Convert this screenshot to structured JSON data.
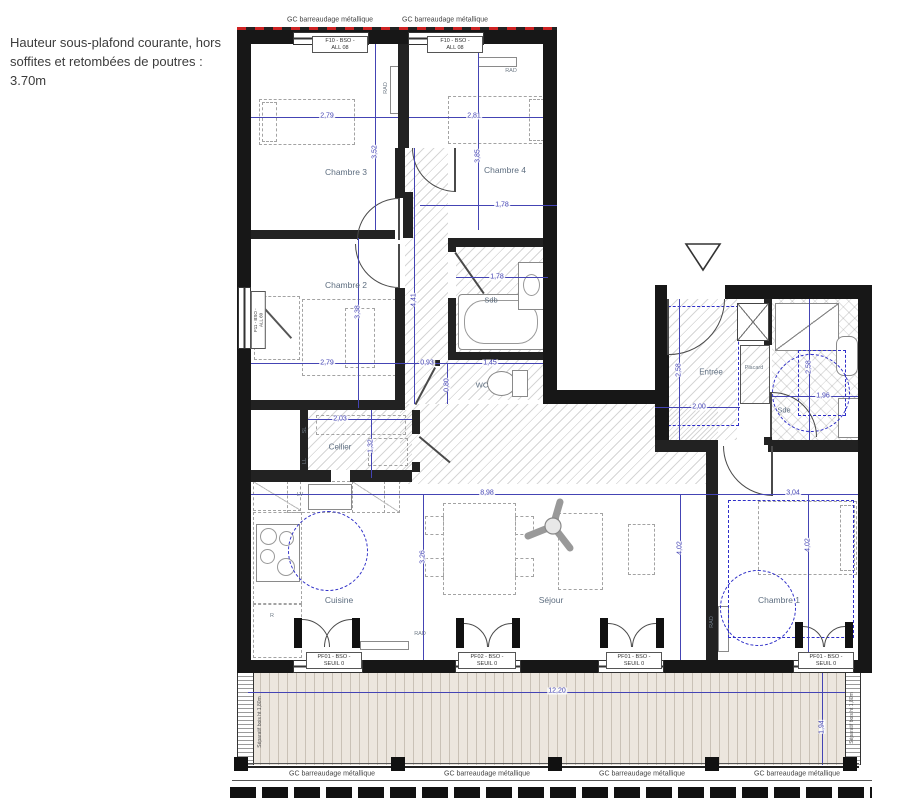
{
  "note": "Hauteur sous-plafond courante, hors\nsoffites et retombées de poutres :\n3.70m",
  "labels": {
    "gc_railing": "GC barreaudage métallique",
    "wood_separator": "Séparatif bois ht 1,80m"
  },
  "tags": {
    "f10": {
      "line1": "F10 - BSO -",
      "line2": "ALL 08"
    },
    "f11": {
      "line1": "F11 - BSO -",
      "line2": "ALL 60"
    },
    "pf01": {
      "line1": "PF01 - BSO -",
      "line2": "SEUIL 0"
    },
    "pf02": {
      "line1": "PF02 - BSO -",
      "line2": "SEUIL 0"
    }
  },
  "rooms": {
    "ch1": "Chambre 1",
    "ch2": "Chambre 2",
    "ch3": "Chambre 3",
    "ch4": "Chambre 4",
    "sejour": "Séjour",
    "cuisine": "Cuisine",
    "cellier": "Cellier",
    "entree": "Entrée",
    "sdb": "Sdb",
    "wc": "WC",
    "sde": "Sde",
    "placard": "Placard"
  },
  "appliances": {
    "rad": "RAD",
    "lv": "LV",
    "sl": "SL",
    "ll": "LL",
    "r": "R"
  },
  "dims": {
    "ch3_w": "2,79",
    "ch3_h": "3,52",
    "ch4_w": "2,81",
    "ch4_h": "3,85",
    "ch4_b": "1,78",
    "sdb_w": "1,78",
    "ch2_w": "2,79",
    "hall_w": "0,93",
    "wc_w": "1,45",
    "wc_h": "0,80",
    "hall_h": "4,41",
    "ch2_h": "3,38",
    "cellier_w": "2,03",
    "cellier_h": "1,32",
    "entree_h": "2,58",
    "entree_w": "2,00",
    "sde_h": "2,58",
    "sde_w": "1,96",
    "sejour_w": "8,98",
    "ch1_w": "3,04",
    "cuisine_h": "3,26",
    "sejour_h": "4,02",
    "ch1_h": "4,02",
    "balcon_w": "12,20",
    "balcon_h": "1,94"
  },
  "colors": {
    "wall": "#171717",
    "dimension_blue": "#4444b4",
    "zone_blue": "#2e2ec8",
    "red_limit": "#cc2222",
    "deck": "#ece6de"
  }
}
